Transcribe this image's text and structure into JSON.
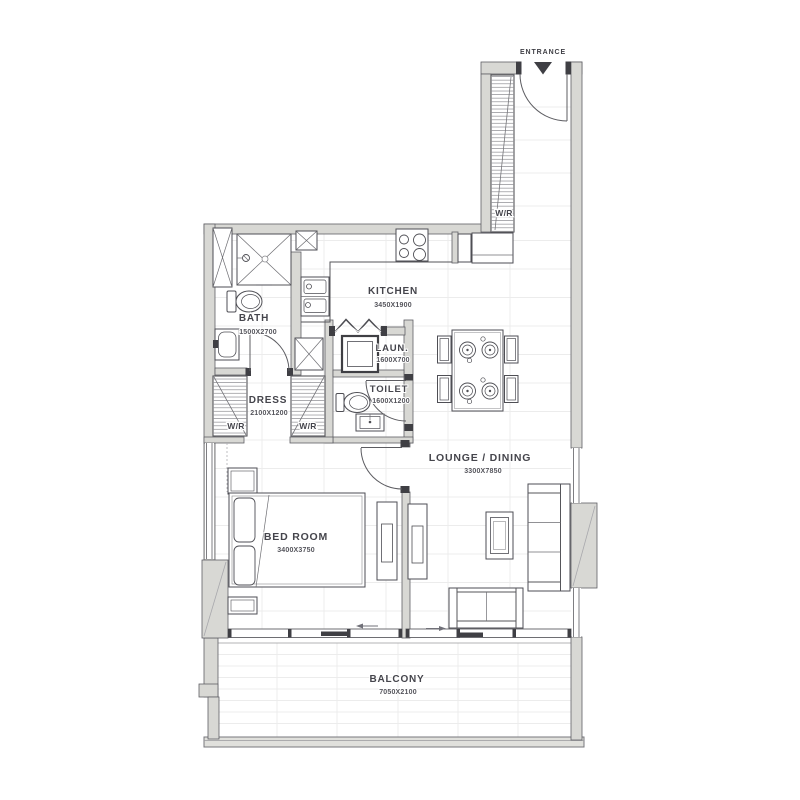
{
  "entrance": {
    "label": "ENTRANCE"
  },
  "rooms": {
    "kitchen": {
      "name": "KITCHEN",
      "dimensions": "3450X1900"
    },
    "bath": {
      "name": "BATH",
      "dimensions": "1500X2700"
    },
    "laundry": {
      "name": "LAUN.",
      "dimensions": "1600X700"
    },
    "toilet": {
      "name": "TOILET",
      "dimensions": "1600X1200"
    },
    "dress": {
      "name": "DRESS",
      "dimensions": "2100X1200"
    },
    "bedroom": {
      "name": "BED ROOM",
      "dimensions": "3400X3750"
    },
    "lounge": {
      "name": "LOUNGE / DINING",
      "dimensions": "3300X7850"
    },
    "balcony": {
      "name": "BALCONY",
      "dimensions": "7050X2100"
    }
  },
  "wardrobes": {
    "hall": "W/R",
    "dress_left": "W/R",
    "dress_right": "W/R"
  },
  "colors": {
    "wall_fill": "#d8d8d4",
    "wall_stroke": "#5f5f64",
    "line": "#4e4e54",
    "dark_accent": "#3f3f44",
    "tile_line": "#ececec",
    "text": "#45454c",
    "background": "#ffffff"
  }
}
